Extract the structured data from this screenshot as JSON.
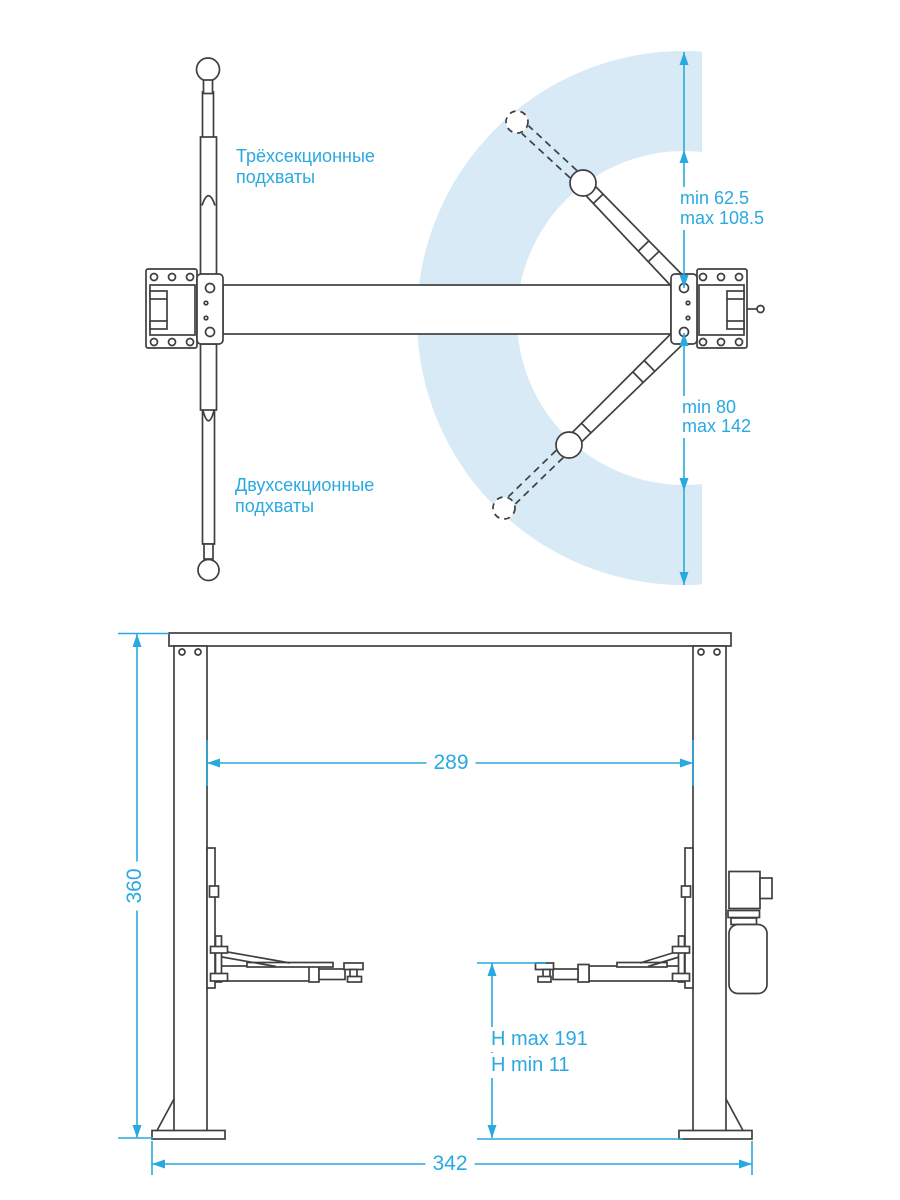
{
  "colors": {
    "line": "#3f3f41",
    "accent": "#29a9e1",
    "arc_fill": "#d7eaf6",
    "background": "#ffffff"
  },
  "top_view": {
    "labels": {
      "three_section_line1": "Трёхсекционные",
      "three_section_line2": "подхваты",
      "two_section_line1": "Двухсекционные",
      "two_section_line2": "подхваты"
    },
    "dimensions": {
      "upper_arm_min": "min 62.5",
      "upper_arm_max": "max 108.5",
      "lower_arm_min": "min 80",
      "lower_arm_max": "max 142"
    }
  },
  "front_view": {
    "dimensions": {
      "clearance_width": "289",
      "overall_height": "360",
      "lift_height_max": "H max 191",
      "lift_height_min": "H min 11",
      "overall_width": "342"
    }
  }
}
